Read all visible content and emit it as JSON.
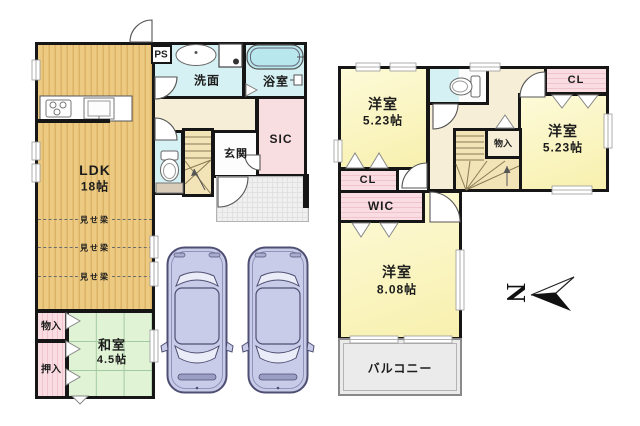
{
  "compass": {
    "label": "N"
  },
  "floor1": {
    "ldk": {
      "name": "LDK",
      "area": "18帖"
    },
    "beam_label": "見せ梁",
    "storage_label": "物入",
    "oshiire_label": "押入",
    "washitsu": {
      "name": "和室",
      "area": "4.5帖"
    },
    "senmen_label": "洗面",
    "bath_label": "浴室",
    "ps_label": "PS",
    "genkan_label": "玄関",
    "sic_label": "SIC"
  },
  "floor2": {
    "bedroom_nw": {
      "name": "洋室",
      "area": "5.23帖"
    },
    "bedroom_e": {
      "name": "洋室",
      "area": "5.23帖"
    },
    "bedroom_s": {
      "name": "洋室",
      "area": "8.08帖"
    },
    "cl_left_label": "CL",
    "cl_right_label": "CL",
    "storage_label": "物入",
    "wic_label": "WIC",
    "balcony_label": "バルコニー"
  },
  "colors": {
    "wall": "#161616",
    "wood_floor": "#ecca82",
    "tatami_green": "#e0f4d5",
    "water_cyan": "#d6f1f4",
    "closet_pink": "#f8d7dc",
    "room_yellow": "#fbf6c3",
    "hall_cream": "#f7eed7",
    "stairs_tan": "#f3e4b8",
    "porch_gray": "#f0f0f0",
    "balcony_gray": "#ebebeb",
    "car_body": "#c9cce9"
  }
}
